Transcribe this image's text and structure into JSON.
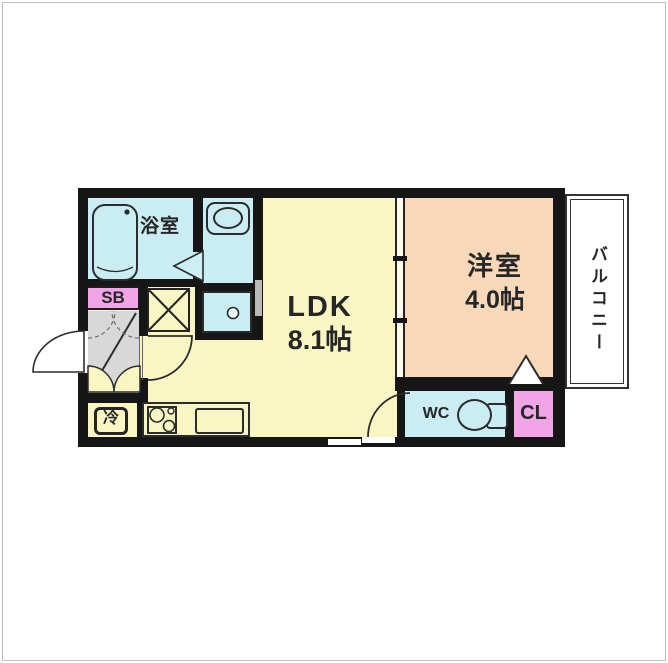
{
  "rooms": {
    "bathroom": {
      "label": "浴室"
    },
    "ldk": {
      "name_label": "LDK",
      "size_label": "8.1帖"
    },
    "western_room": {
      "name_label": "洋室",
      "size_label": "4.0帖"
    },
    "balcony": {
      "label": "バルコニー"
    },
    "shoe_box": {
      "label": "SB"
    },
    "wc": {
      "label": "WC"
    },
    "closet": {
      "label": "CL"
    },
    "refrigerator": {
      "label": "冷"
    }
  },
  "colors": {
    "wall": "#161616",
    "ldk_floor": "#faf6c3",
    "western_floor": "#f7d9ba",
    "wet_area_floor": "#c9edf2",
    "pink_storage": "#f1a5e7",
    "entrance_gray": "#d8d8d8",
    "balcony": "#ffffff"
  }
}
